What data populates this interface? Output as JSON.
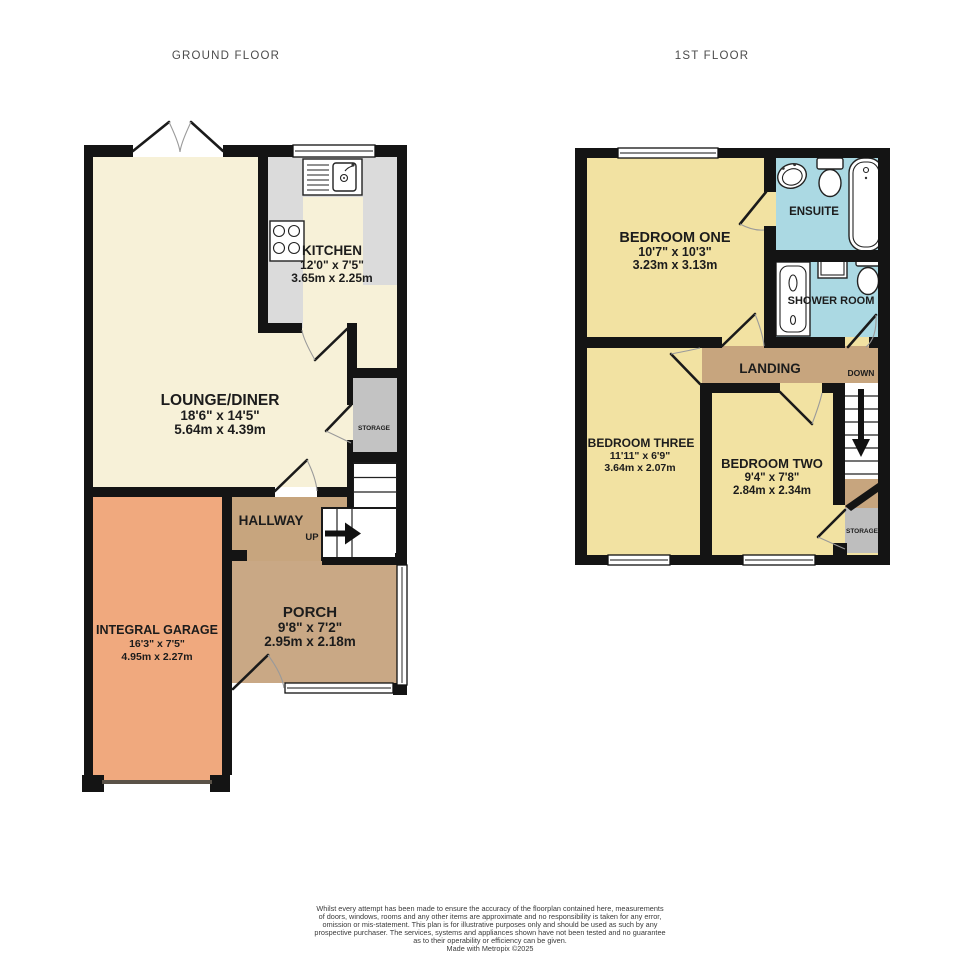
{
  "titles": {
    "ground_floor": "GROUND FLOOR",
    "first_floor": "1ST FLOOR"
  },
  "ground_floor": {
    "lounge_diner": {
      "name": "LOUNGE/DINER",
      "imperial": "18'6\"  x 14'5\"",
      "metric": "5.64m  x 4.39m"
    },
    "kitchen": {
      "name": "KITCHEN",
      "imperial": "12'0\"  x 7'5\"",
      "metric": "3.65m  x 2.25m"
    },
    "hallway": {
      "name": "HALLWAY",
      "stairs_label": "UP"
    },
    "storage": {
      "name": "STORAGE"
    },
    "porch": {
      "name": "PORCH",
      "imperial": "9'8\"  x 7'2\"",
      "metric": "2.95m  x 2.18m"
    },
    "integral_garage": {
      "name": "INTEGRAL GARAGE",
      "imperial": "16'3\"  x 7'5\"",
      "metric": "4.95m  x 2.27m"
    }
  },
  "first_floor": {
    "bedroom_one": {
      "name": "BEDROOM ONE",
      "imperial": "10'7\"  x 10'3\"",
      "metric": "3.23m  x 3.13m"
    },
    "ensuite": {
      "name": "ENSUITE"
    },
    "shower_room": {
      "name": "SHOWER ROOM"
    },
    "landing": {
      "name": "LANDING",
      "stairs_label": "DOWN"
    },
    "bedroom_three": {
      "name": "BEDROOM THREE",
      "imperial": "11'11\"  x 6'9\"",
      "metric": "3.64m  x 2.07m"
    },
    "bedroom_two": {
      "name": "BEDROOM TWO",
      "imperial": "9'4\"  x 7'8\"",
      "metric": "2.84m  x 2.34m"
    },
    "storage": {
      "name": "STORAGE"
    }
  },
  "footer": {
    "lines": [
      "Whilst every attempt has been made to ensure the accuracy of the floorplan contained here, measurements",
      "of doors, windows, rooms and any other items are approximate and no responsibility is taken for any error,",
      "omission or mis-statement. This plan is for illustrative purposes only and should be used as such by any",
      "prospective purchaser. The services, systems and appliances shown have not been tested and no guarantee",
      "as to their operability or efficiency can be given.",
      "Made with Metropix ©2025"
    ]
  },
  "colors": {
    "wall": "#141414",
    "lounge_cream": "#F7F1D8",
    "bedroom_yellow": "#F2E2A2",
    "circulation_tan": "#C7A57E",
    "garage_orange": "#F0A97E",
    "bathroom_blue": "#ABD9E3",
    "counter_gray": "#DBDBDB",
    "storage_gray": "#C3C3C3"
  }
}
